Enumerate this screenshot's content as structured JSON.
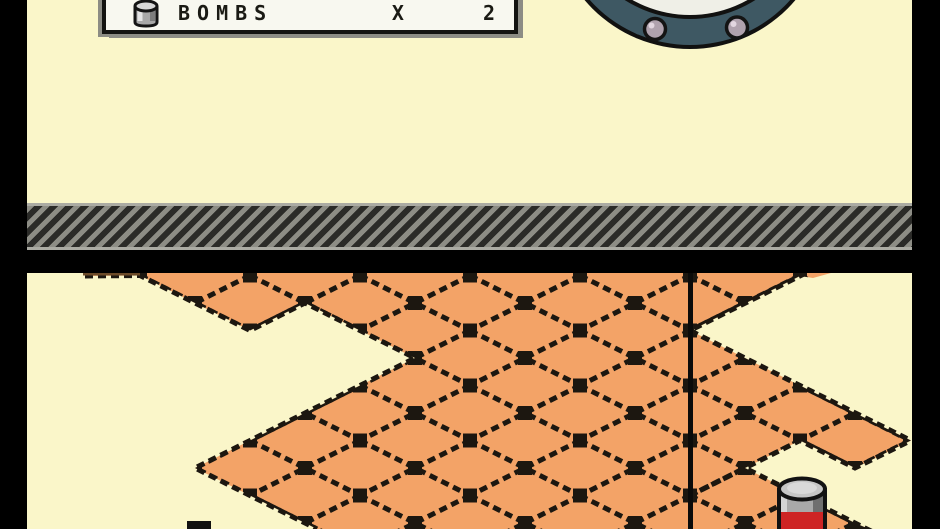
{
  "hud": {
    "bombs_label": "BOMBS",
    "times_symbol": "X",
    "bombs_count": "2"
  },
  "icons": {
    "hud_bomb": "bomb-canister-icon",
    "top_object": "porthole-hatch",
    "separator": "hazard-stripes-bar",
    "floor_object": "bomb-canister"
  },
  "colors": {
    "screen_cream": "#FAF6C9",
    "tile_orange": "#F3A367",
    "tile_line": "#1C1710",
    "frame_black": "#000000",
    "hatch_gray": "#8D8D85",
    "hatch_stripe_dark": "#2B2B28",
    "porthole_ring_slate": "#3E5863",
    "porthole_inner_white": "#EFEFE7",
    "rivet_gray": "#B0A2AE",
    "canister_gray": "#A9A9A9",
    "canister_red": "#CE2424",
    "counter_box_bg": "#F8F8F0",
    "counter_shadow": "#8C8C84"
  }
}
